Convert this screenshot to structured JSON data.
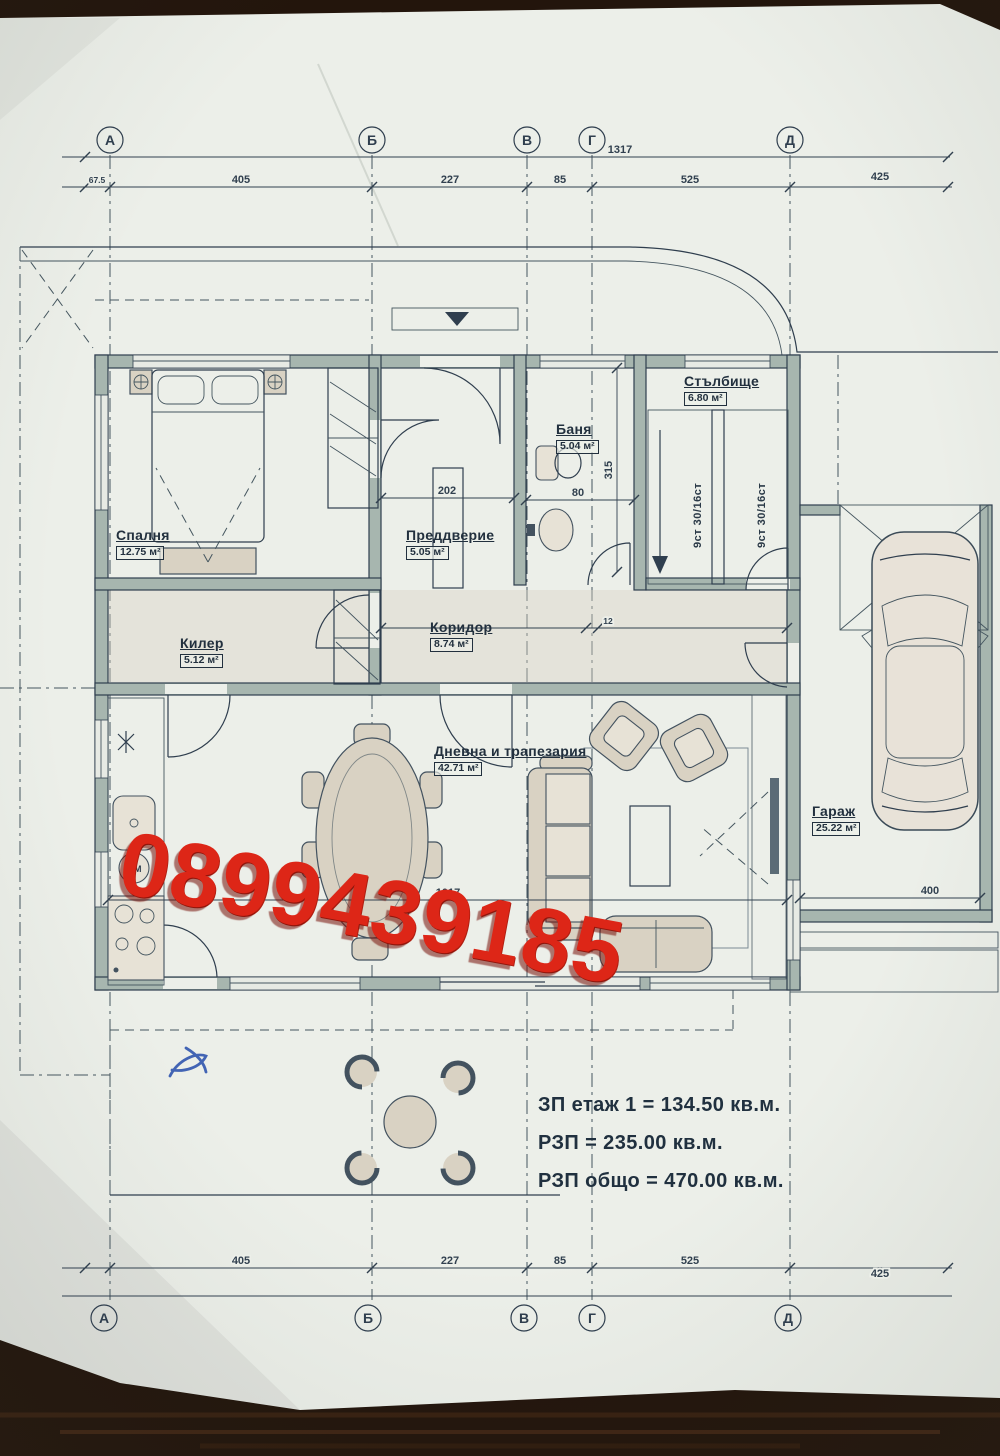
{
  "watermark": {
    "phone": "0899439185",
    "color": "#dd2617"
  },
  "axes": {
    "letters": [
      "А",
      "Б",
      "В",
      "Г",
      "Д"
    ]
  },
  "dims": {
    "overall": "1317",
    "left_offset": "67.5",
    "top": [
      "405",
      "227",
      "85",
      "525",
      "425"
    ],
    "bottom": [
      "405",
      "227",
      "85",
      "525",
      "425"
    ],
    "vestibule": "202",
    "bath": "80",
    "bath_side": "315",
    "wall": "12",
    "living": "1017",
    "garage": "400"
  },
  "rooms": [
    {
      "name": "Спалня",
      "area": "12.75 м²"
    },
    {
      "name": "Килер",
      "area": "5.12 м²"
    },
    {
      "name": "Преддверие",
      "area": "5.05 м²"
    },
    {
      "name": "Баня",
      "area": "5.04 м²"
    },
    {
      "name": "Стълбище",
      "area": "6.80 м²"
    },
    {
      "name": "Коридор",
      "area": "8.74 м²"
    },
    {
      "name": "Дневна и трапезария",
      "area": "42.71 м²"
    },
    {
      "name": "Гараж",
      "area": "25.22 м²"
    }
  ],
  "stairs": {
    "flight_label": "9ст 30/16ст"
  },
  "appliances": {
    "washing_machine": "MM"
  },
  "summary": {
    "line1": "ЗП етаж 1 = 134.50 кв.м.",
    "line2": "РЗП = 235.00 кв.м.",
    "line3": "РЗП общо = 470.00 кв.м."
  },
  "colors": {
    "paper": "#ecefe9",
    "ink": "#2f3e4e",
    "wall_fill": "#a7b6af",
    "furniture_fill": "#d9d2c3",
    "watermark_red": "#dd2617",
    "wood_dark": "#23150c",
    "pen_blue": "#3054ae"
  }
}
